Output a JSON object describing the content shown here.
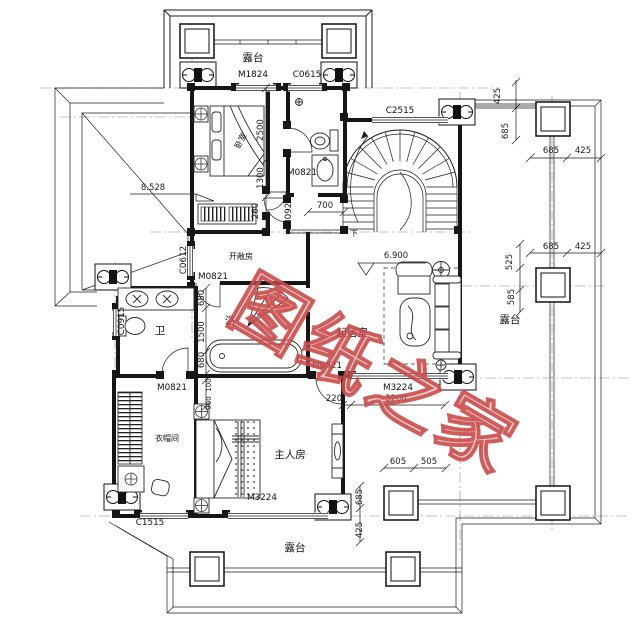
{
  "plan": {
    "watermark_text": "图纸之家",
    "watermark_color": "#c94848",
    "line_color": "#1c1c1c",
    "levels": {
      "roof_elevation": "8.528",
      "floor_elevation": "6.900",
      "stair_direction": "下"
    },
    "rooms": {
      "terrace": "露台",
      "bedroom": "卧室",
      "open_room": "开敞房",
      "bath": "浴",
      "toilet": "卫",
      "living_room": "起居室",
      "cloakroom": "衣帽间",
      "master_bedroom": "主人房"
    },
    "openings": {
      "m1824": "M1824",
      "c0615": "C0615",
      "c2515": "C2515",
      "m0821": "M0821",
      "m0921": "M0921",
      "c0612": "C0612",
      "c0915": "C0915",
      "m3224": "M3224",
      "c1515": "C1515"
    },
    "dims": {
      "d2500": "2500",
      "d1300": "1300",
      "d260": "260",
      "d700": "700",
      "d680": "680",
      "d1500": "1500",
      "d100": "100",
      "d900": "900",
      "d220": "220",
      "d3200": "3200",
      "d605": "605",
      "d505": "505",
      "d685": "685",
      "d425": "425",
      "d525": "525",
      "d585": "585"
    }
  }
}
